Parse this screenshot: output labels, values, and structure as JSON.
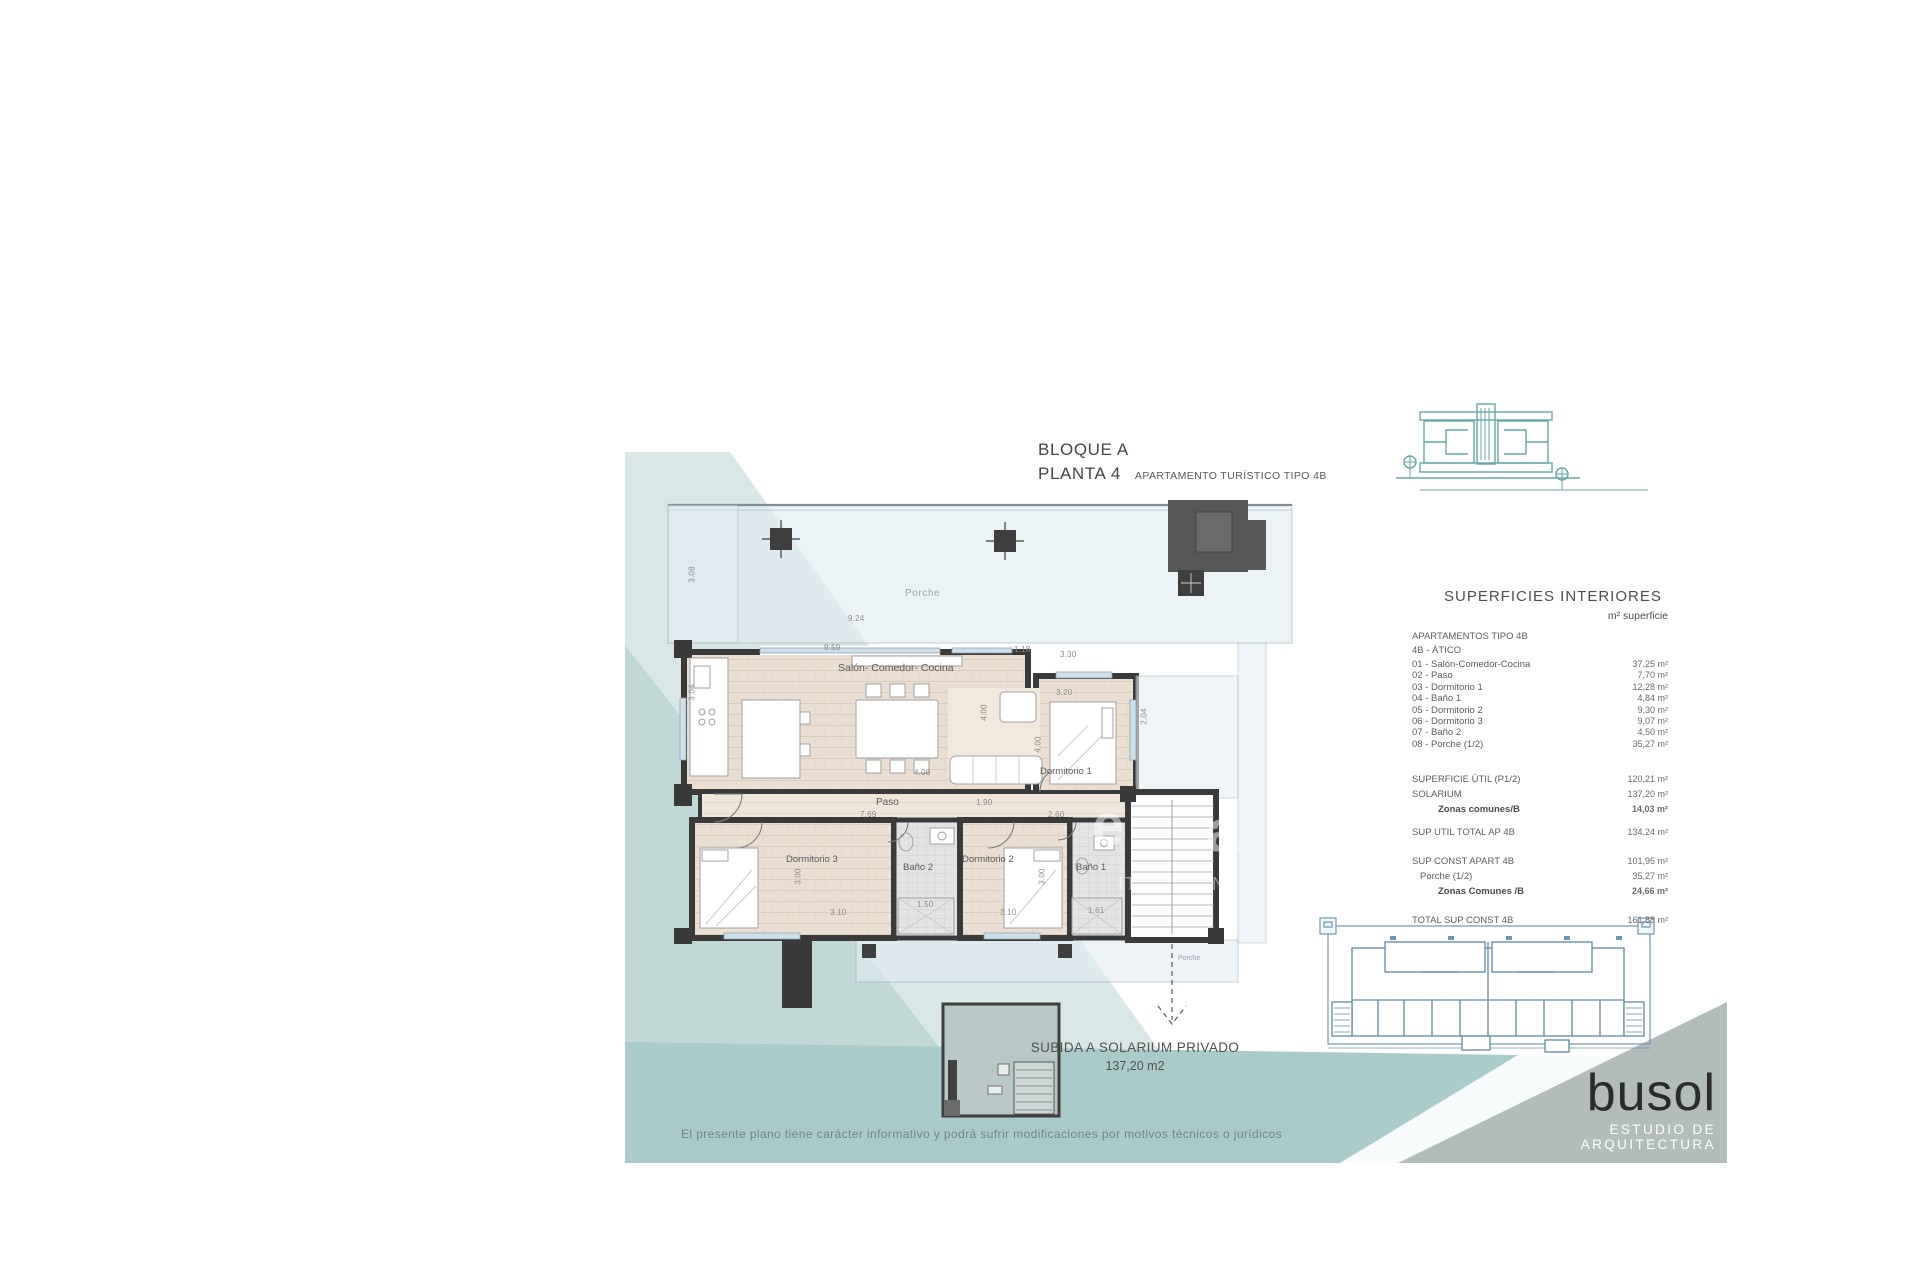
{
  "title": {
    "line1": "BLOQUE A",
    "line2": "PLANTA 4",
    "subtitle": "APARTAMENTO TURÍSTICO TIPO 4B"
  },
  "plan": {
    "rooms": {
      "porche_top": "Porche",
      "salon": "Salón- Comedor- Cocina",
      "dorm1": "Dormitorio 1",
      "paso": "Paso",
      "dorm3": "Dormitorio 3",
      "bano2": "Baño 2",
      "dorm2": "Dormitorio 2",
      "bano1": "Baño 1",
      "porche_bottom": "Porche"
    },
    "dims": {
      "d924": "9.24",
      "d959": "9.59",
      "d118": "1.18",
      "d330": "3.30",
      "d320": "3.20",
      "d204": "2.04",
      "d400a": "4.00",
      "d400b": "4.00",
      "d308": "3.08",
      "d304": "3.04",
      "d408": "4.08",
      "d769": "7.69",
      "d190": "1.90",
      "d260": "2.60",
      "d300a": "3.00",
      "d310a": "3.10",
      "d150": "1.50",
      "d300b": "3.00",
      "d310b": "3.10",
      "d161": "1.61"
    },
    "solarium_note": {
      "line1": "SUBIDA A SOLARIUM PRIVADO",
      "line2": "137,20 m2"
    }
  },
  "surfaces_table": {
    "title": "SUPERFICIES INTERIORES",
    "unit_header": "m² superficie",
    "group1_header": "APARTAMENTOS TIPO 4B",
    "group2_header": "4B - ÁTICO",
    "rows": [
      {
        "label": "01 - Salón-Comedor-Cocina",
        "value": "37,25 m²"
      },
      {
        "label": "02 - Paso",
        "value": "7,70 m²"
      },
      {
        "label": "03 - Dormitorio 1",
        "value": "12,28 m²"
      },
      {
        "label": "04 - Baño 1",
        "value": "4,84 m²"
      },
      {
        "label": "05 - Dormitorio 2",
        "value": "9,30 m²"
      },
      {
        "label": "06 - Dormitorio 3",
        "value": "9,07 m²"
      },
      {
        "label": "07 - Baño 2",
        "value": "4,50 m²"
      },
      {
        "label": "08 - Porche (1/2)",
        "value": "35,27 m²"
      }
    ],
    "summary_util": [
      {
        "label": "SUPERFICIE ÚTIL (P1/2)",
        "value": "120,21 m²"
      },
      {
        "label": "SOLARIUM",
        "value": "137,20 m²"
      },
      {
        "label": "Zonas comunes/B",
        "value": "14,03 m²"
      }
    ],
    "total_util": {
      "label": "SUP UTIL TOTAL AP 4B",
      "value": "134,24 m²"
    },
    "summary_const": [
      {
        "label": "SUP CONST APART 4B",
        "value": "101,95 m²"
      },
      {
        "label": "Porche (1/2)",
        "value": "35,27 m²"
      },
      {
        "label": "Zonas Comunes /B",
        "value": "24,66 m²"
      }
    ],
    "total_const": {
      "label": "TOTAL SUP CONST 4B",
      "value": "161,88 m²"
    }
  },
  "watermark": {
    "frag1": "e",
    "frag2": "a",
    "frag3": "IT",
    "frag4": "N"
  },
  "brand": {
    "name": "busol",
    "tagline": "ESTUDIO DE ARQUITECTURA"
  },
  "footer": {
    "disclaimer": "El presente plano tiene carácter informativo y podrá sufrir modificaciones por motivos técnicos o  jurídicos"
  },
  "colors": {
    "accent_teal_logo": "#64a7a6",
    "wall": "#3a3a3a",
    "wood_floor": "#eadfd2",
    "glass": "#dce8f0",
    "wave_light": "#d9e8e6",
    "wave_mid": "#c0d9d7",
    "wave_deep": "#a9cbc9",
    "wedge_gray": "#b2bcba",
    "siteplan_blue": "#6e96b0"
  }
}
